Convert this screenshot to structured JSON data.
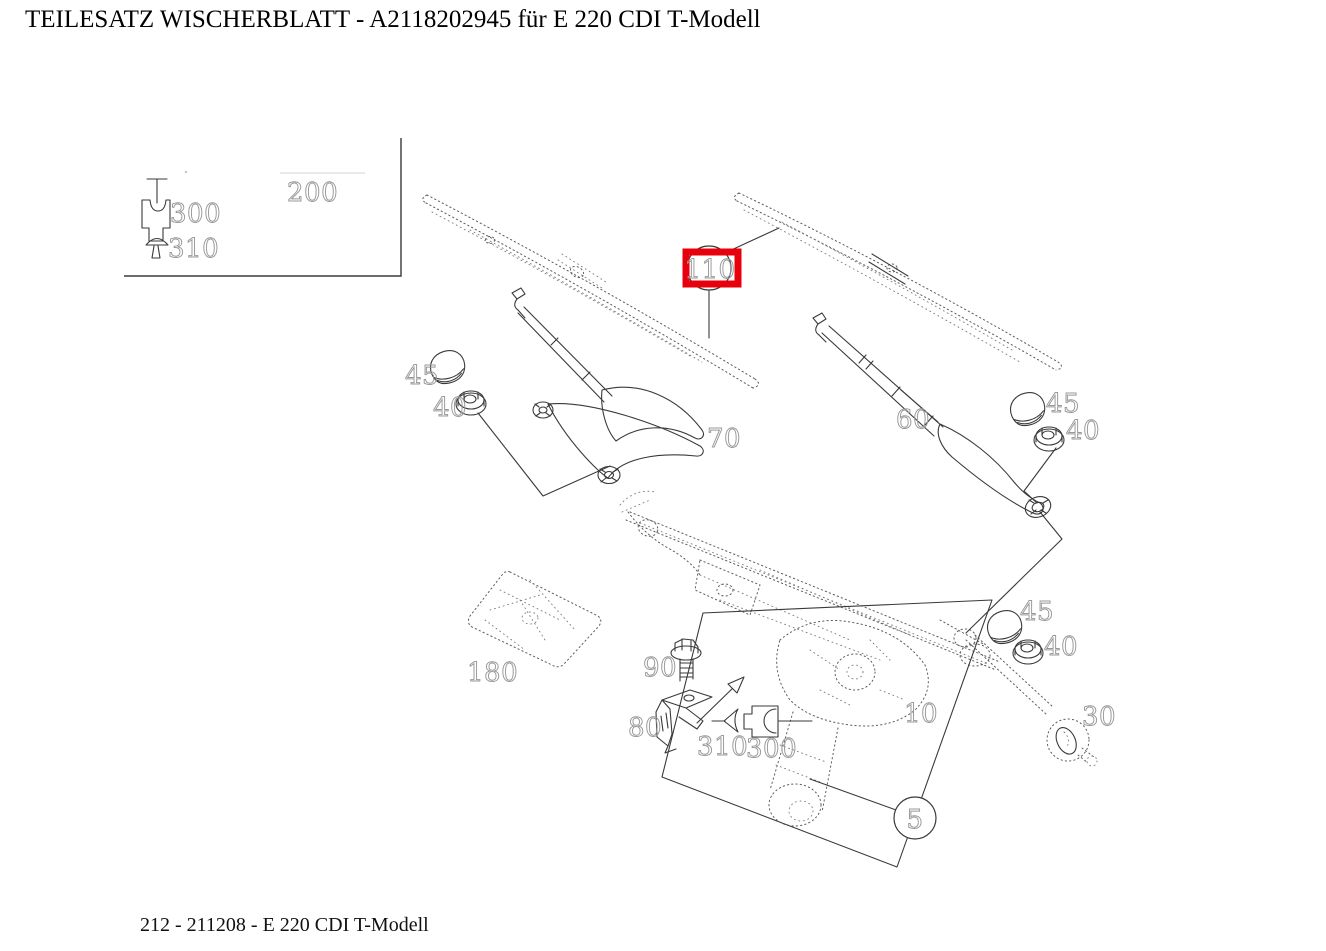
{
  "title": "TEILESATZ WISCHERBLATT  - A2118202945 für E 220 CDI T-Modell",
  "footer": "212 - 211208 - E 220 CDI T-Modell",
  "highlight": {
    "selected_part": "110",
    "box_color": "#e8000d"
  },
  "legend": {
    "p200": "200",
    "p300": "300",
    "p310": "310"
  },
  "callouts": {
    "p110": "110",
    "p45_left": "45",
    "p40_left": "40",
    "p70": "70",
    "p60": "60",
    "p45_right_top": "45",
    "p40_right_top": "40",
    "p180": "180",
    "p90": "90",
    "p80": "80",
    "p310_main": "310",
    "p300_main": "300",
    "p10": "10",
    "p45_right_bottom": "45",
    "p40_right_bottom": "40",
    "p30": "30",
    "p5": "5"
  }
}
